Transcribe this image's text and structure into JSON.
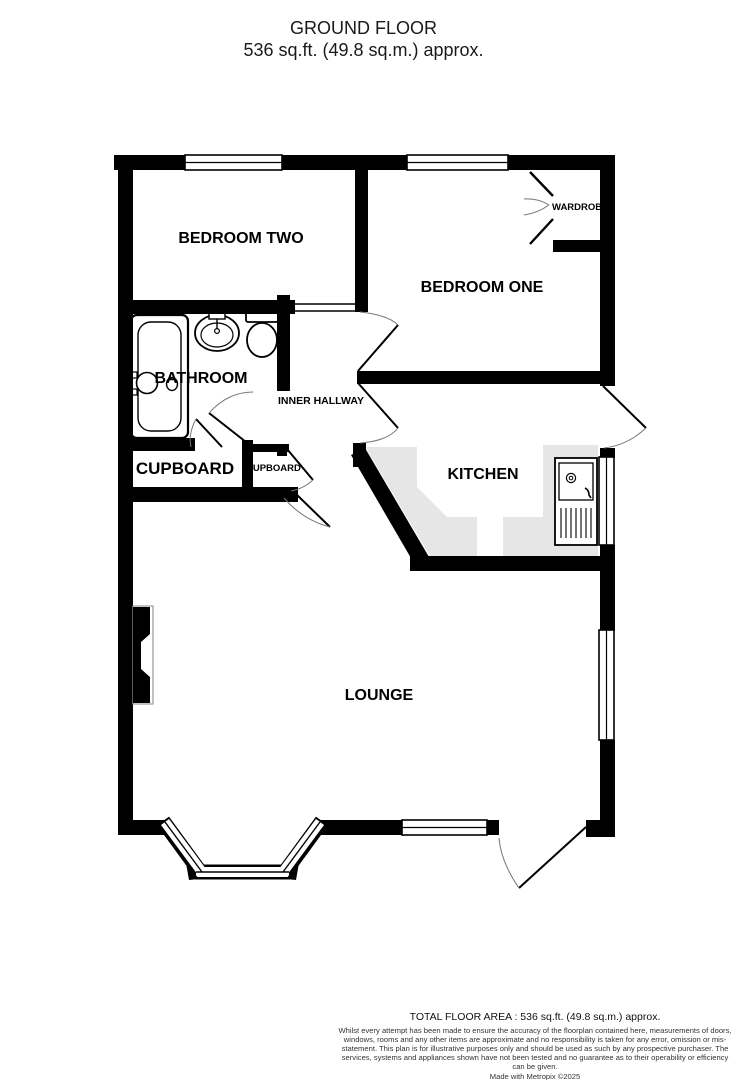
{
  "title": {
    "line1": "GROUND FLOOR",
    "line2": "536 sq.ft. (49.8 sq.m.) approx."
  },
  "rooms": {
    "bedroom_two": "BEDROOM TWO",
    "bedroom_one": "BEDROOM ONE",
    "wardrobe": "WARDROBE",
    "bathroom": "BATHROOM",
    "inner_hallway": "INNER HALLWAY",
    "cupboard": "CUPBOARD",
    "cupboard_small": "CUPBOARD",
    "kitchen": "KITCHEN",
    "lounge": "LOUNGE"
  },
  "footer": {
    "total_area": "TOTAL FLOOR AREA : 536 sq.ft. (49.8 sq.m.) approx.",
    "disclaimer": "Whilst every attempt has been made to ensure the accuracy of the floorplan contained here, measurements of doors, windows, rooms and any other items are approximate and no responsibility is taken for any error, omission or mis-statement. This plan is for illustrative purposes only and should be used as such by any prospective purchaser. The services, systems and appliances shown have not been tested and no guarantee as to their operability or efficiency can be given.",
    "credit": "Made with Metropix ©2025"
  },
  "colors": {
    "wall": "#000000",
    "counter": "#e6e6e6",
    "background": "#ffffff"
  }
}
